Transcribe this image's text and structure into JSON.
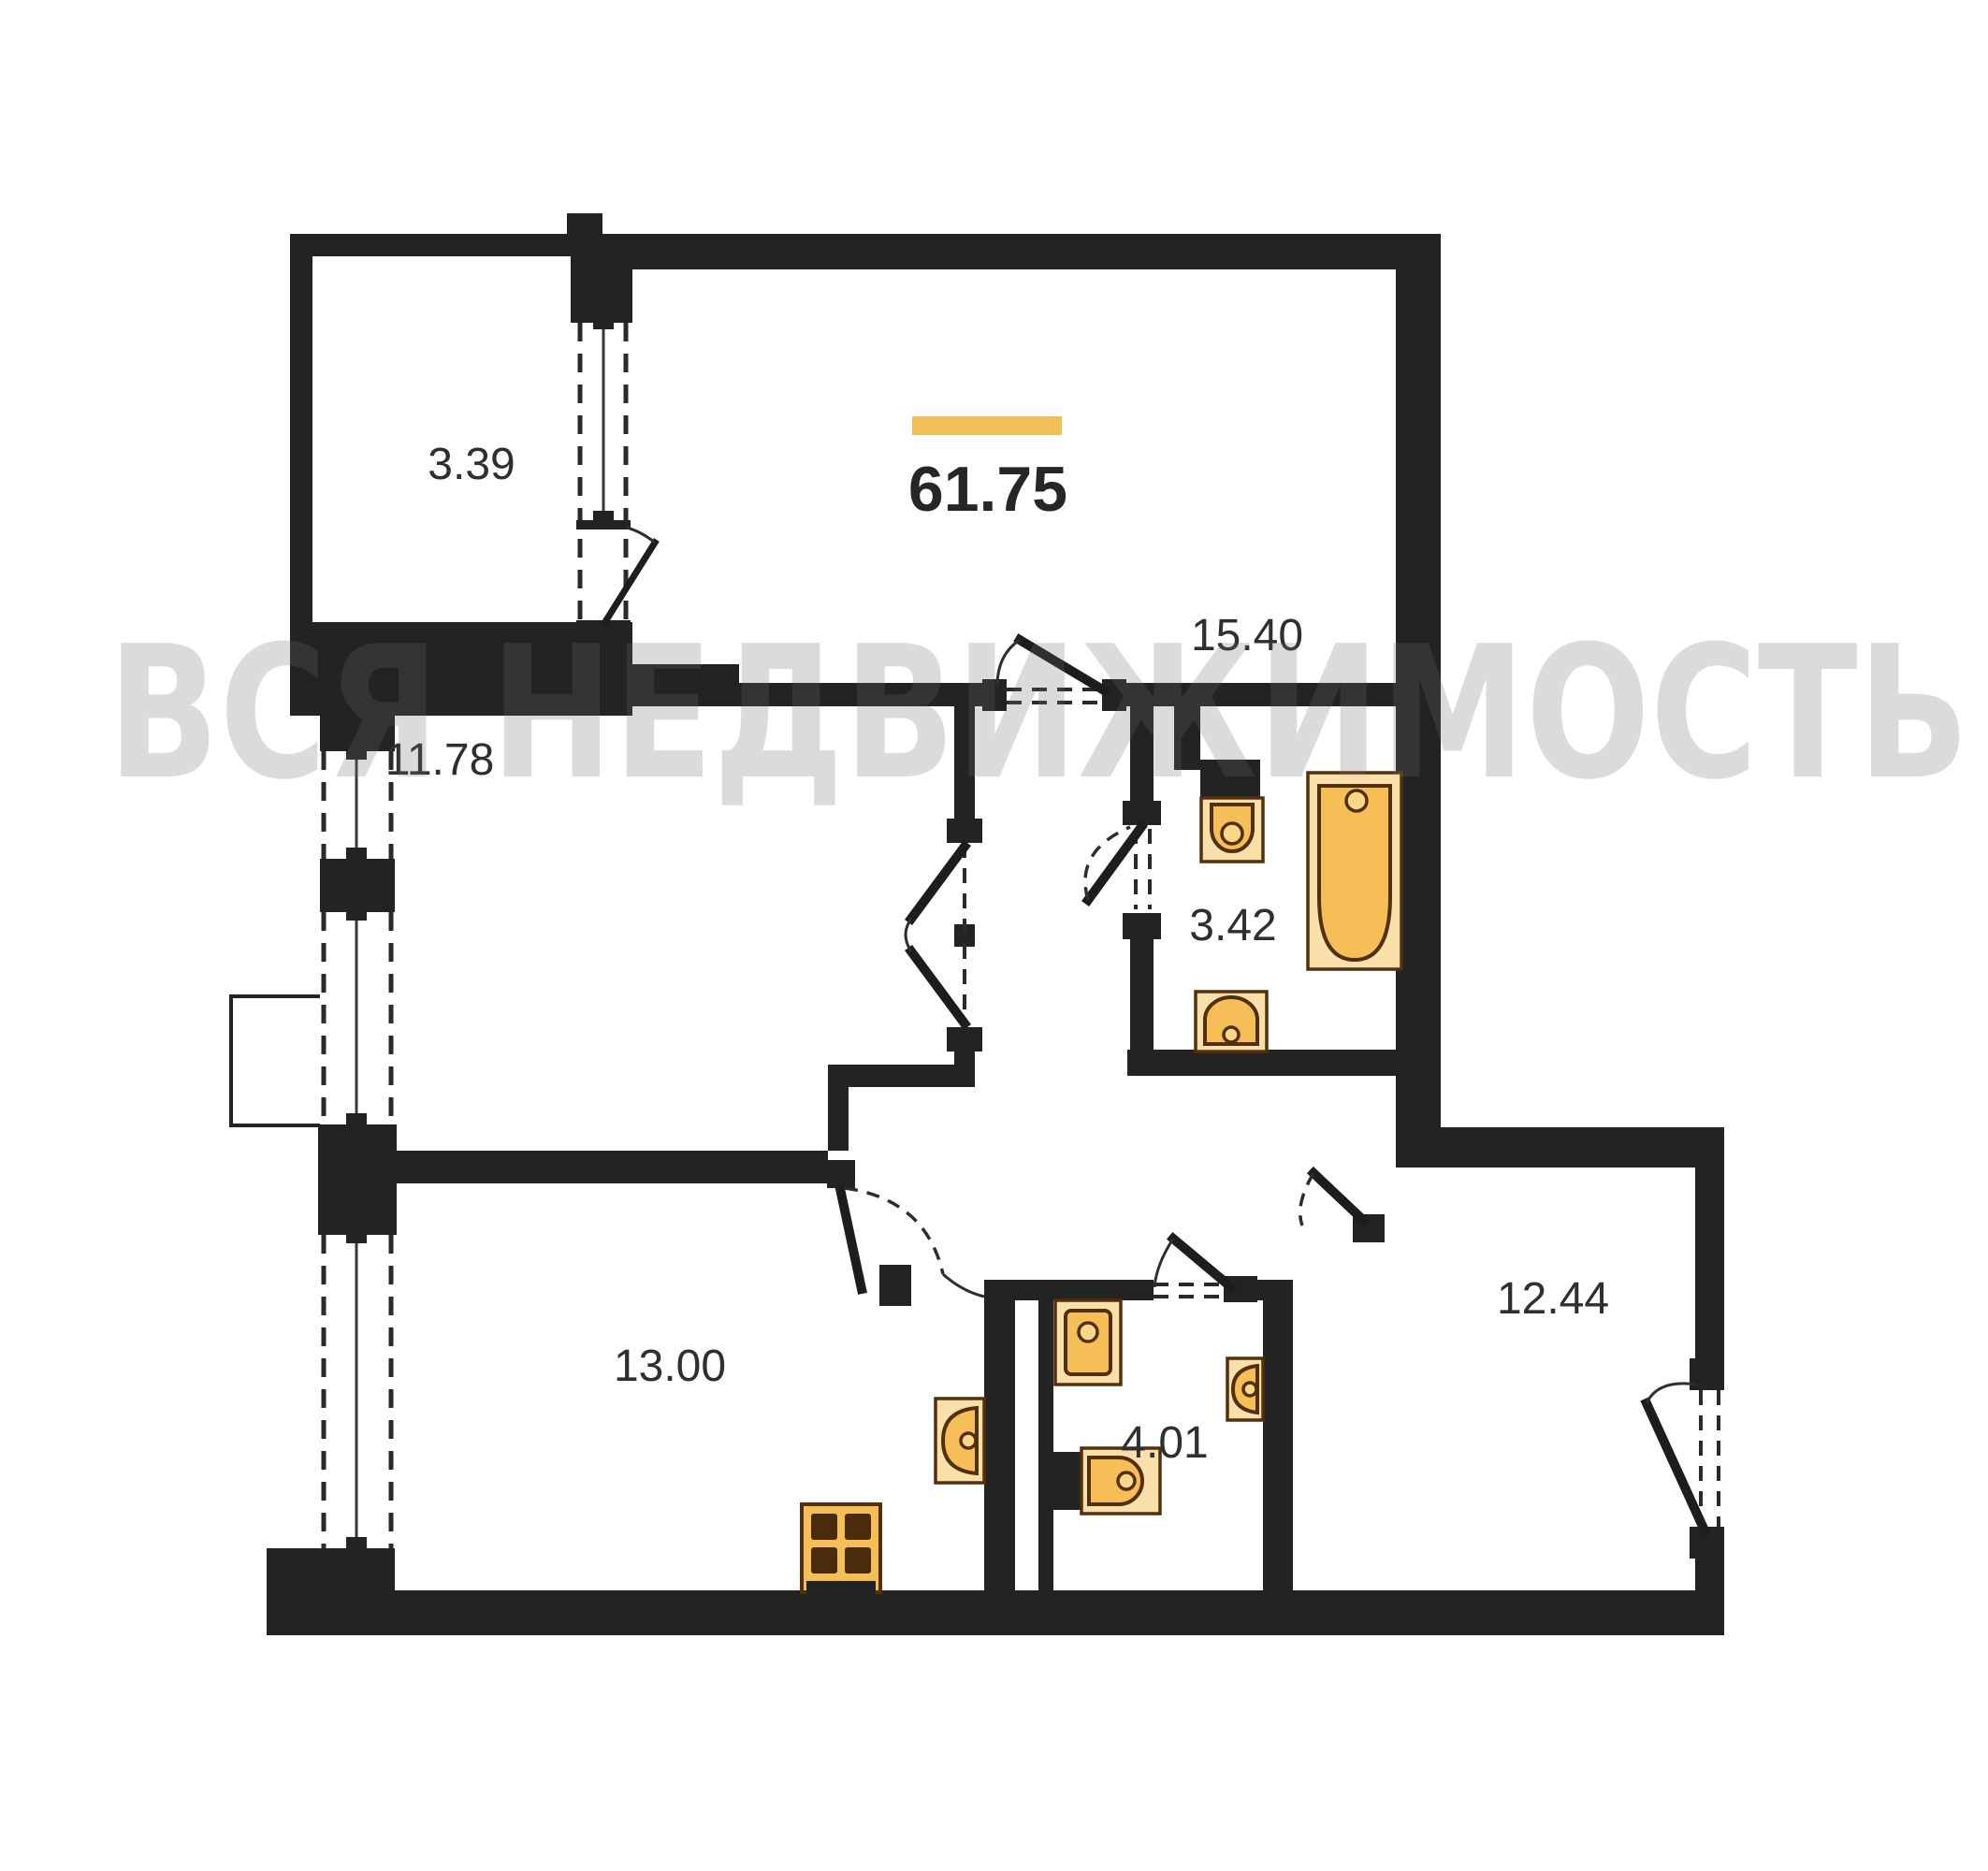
{
  "watermark": {
    "text": "ВСЯ НЕДВИЖИМОСТЬ"
  },
  "plan": {
    "type": "apartment-floor-plan",
    "total": {
      "area": "61.75",
      "accent_bar_color": "#F2BE58"
    },
    "rooms": [
      {
        "id": "balcony",
        "area": "3.39"
      },
      {
        "id": "living-room",
        "area": "15.40"
      },
      {
        "id": "bedroom",
        "area": "11.78"
      },
      {
        "id": "bathroom",
        "area": "3.42"
      },
      {
        "id": "kitchen-living",
        "area": "13.00"
      },
      {
        "id": "wc",
        "area": "4.01"
      },
      {
        "id": "hall",
        "area": "12.44"
      }
    ],
    "fixtures": [
      "bathtub-icon",
      "toilet-icon",
      "sink-icon",
      "washing-machine-icon",
      "toilet-icon",
      "sink-icon",
      "kitchen-sink-icon",
      "stove-icon"
    ],
    "colors": {
      "walls": "#232323",
      "fixture_orange": "#F6BE56",
      "fixture_pale": "#F9DFA9",
      "accent_bar": "#F2BE58",
      "watermark_gray": "#e3e3e3",
      "background": "#ffffff",
      "label_text": "#2f2f2f"
    }
  }
}
